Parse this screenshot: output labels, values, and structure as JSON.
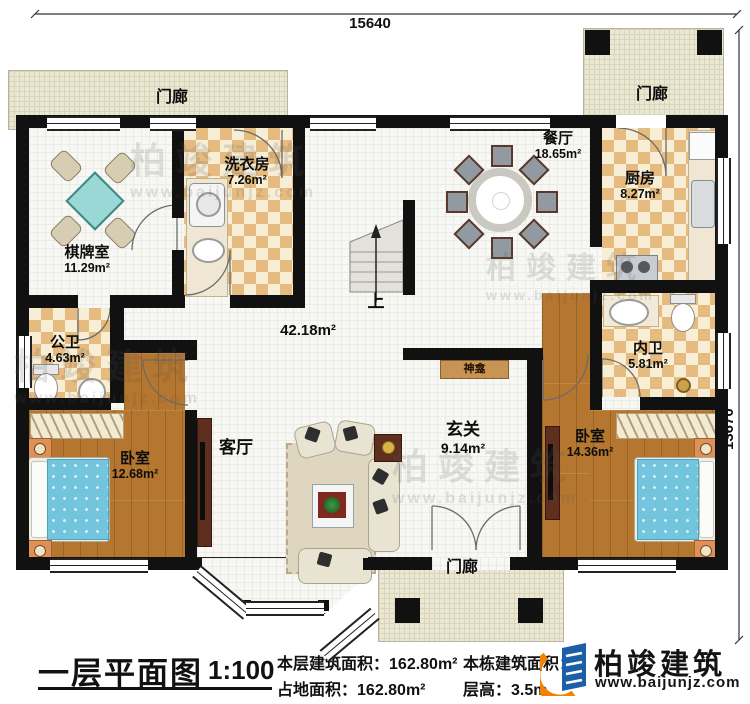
{
  "dimensions": {
    "top": "15640",
    "right": "13670"
  },
  "rooms": {
    "porch_tl": {
      "name": "门廊"
    },
    "porch_tr": {
      "name": "门廊"
    },
    "porch_bottom": {
      "name": "门廊"
    },
    "chess_room": {
      "name": "棋牌室",
      "area": "11.29m²"
    },
    "laundry": {
      "name": "洗衣房",
      "area": "7.26m²"
    },
    "dining": {
      "name": "餐厅",
      "area": "18.65m²"
    },
    "kitchen": {
      "name": "厨房",
      "area": "8.27m²"
    },
    "public_bath": {
      "name": "公卫",
      "area": "4.63m²"
    },
    "inner_bath": {
      "name": "内卫",
      "area": "5.81m²"
    },
    "bedroom_left": {
      "name": "卧室",
      "area": "12.68m²"
    },
    "bedroom_right": {
      "name": "卧室",
      "area": "14.36m²"
    },
    "living": {
      "name": "客厅",
      "area": "42.18m²"
    },
    "foyer": {
      "name": "玄关",
      "area": "9.14m²"
    },
    "shrine": {
      "name": "神龛"
    },
    "stairs": {
      "label": "上"
    }
  },
  "title_block": {
    "title": "一层平面图",
    "scale": "1:100",
    "floor_area_label": "本层建筑面积：",
    "floor_area_value": "162.80m²",
    "land_area_label": "占地面积：",
    "land_area_value": "162.80m²",
    "total_area_label": "本栋建筑面积：",
    "total_area_value_visible": "9",
    "storey_height_label": "层高：",
    "storey_height_value": "3.5m"
  },
  "branding": {
    "logo_name": "柏竣建筑",
    "logo_url": "www.baijunjz.com",
    "watermark_name": "柏竣建筑",
    "watermark_url": "www.baijunjz.com"
  }
}
